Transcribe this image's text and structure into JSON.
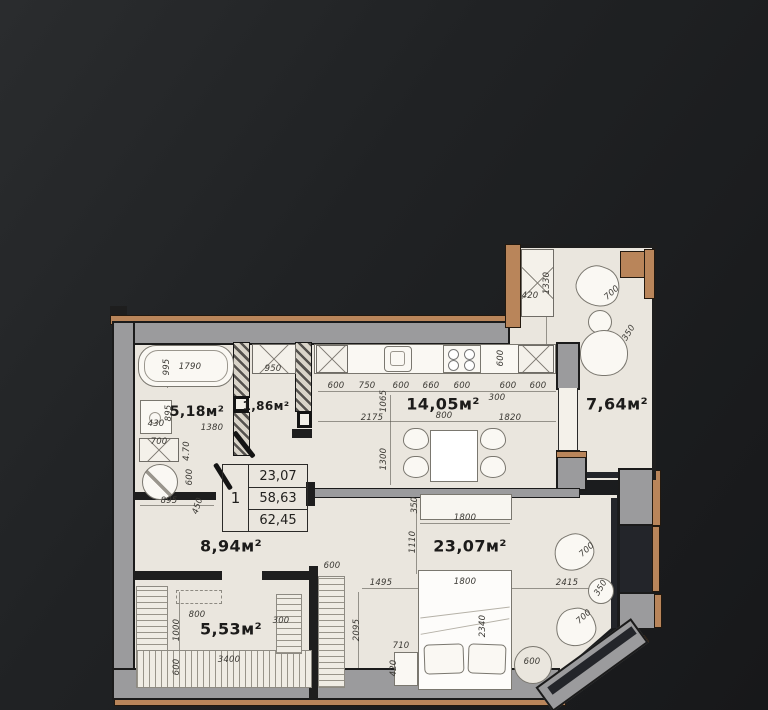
{
  "plan": {
    "title": "apartment-floor-plan",
    "legend": {
      "number": "1",
      "values": [
        "23,07",
        "58,63",
        "62,45"
      ]
    },
    "rooms": [
      {
        "name": "bathroom",
        "area": "5,18м²"
      },
      {
        "name": "closet",
        "area": "1,86м²"
      },
      {
        "name": "kitchen-living-room",
        "area": "14,05м²"
      },
      {
        "name": "balcony",
        "area": "7,64м²"
      },
      {
        "name": "hallway",
        "area": "8,94м²"
      },
      {
        "name": "bedroom",
        "area": "23,07м²"
      },
      {
        "name": "wardrobe-room",
        "area": "5,53м²"
      }
    ],
    "room_labels": [
      {
        "t": "5,18м²",
        "x": 197,
        "y": 412,
        "fs": 14
      },
      {
        "t": "1,86м²",
        "x": 266,
        "y": 406,
        "fs": 12
      },
      {
        "t": "14,05м²",
        "x": 443,
        "y": 404,
        "fs": 16
      },
      {
        "t": "7,64м²",
        "x": 617,
        "y": 404,
        "fs": 16
      },
      {
        "t": "8,94м²",
        "x": 231,
        "y": 546,
        "fs": 16
      },
      {
        "t": "23,07м²",
        "x": 470,
        "y": 546,
        "fs": 16
      },
      {
        "t": "5,53м²",
        "x": 231,
        "y": 629,
        "fs": 16
      }
    ],
    "dimensions": [
      {
        "t": "995",
        "x": 167,
        "y": 367,
        "r": -90
      },
      {
        "t": "1790",
        "x": 190,
        "y": 367
      },
      {
        "t": "950",
        "x": 273,
        "y": 369
      },
      {
        "t": "600",
        "x": 336,
        "y": 386
      },
      {
        "t": "750",
        "x": 367,
        "y": 386
      },
      {
        "t": "600",
        "x": 401,
        "y": 386
      },
      {
        "t": "660",
        "x": 431,
        "y": 386
      },
      {
        "t": "600",
        "x": 462,
        "y": 386
      },
      {
        "t": "600",
        "x": 508,
        "y": 386
      },
      {
        "t": "600",
        "x": 538,
        "y": 386
      },
      {
        "t": "600",
        "x": 501,
        "y": 358,
        "r": -90
      },
      {
        "t": "1065",
        "x": 384,
        "y": 401,
        "r": -90
      },
      {
        "t": "300",
        "x": 497,
        "y": 398
      },
      {
        "t": "2175",
        "x": 372,
        "y": 418
      },
      {
        "t": "800",
        "x": 444,
        "y": 416
      },
      {
        "t": "1820",
        "x": 510,
        "y": 418
      },
      {
        "t": "1300",
        "x": 384,
        "y": 459,
        "r": -90
      },
      {
        "t": "430",
        "x": 156,
        "y": 424
      },
      {
        "t": "895",
        "x": 169,
        "y": 413,
        "r": -90
      },
      {
        "t": "1380",
        "x": 212,
        "y": 428
      },
      {
        "t": "700",
        "x": 159,
        "y": 442
      },
      {
        "t": "4.70",
        "x": 187,
        "y": 451,
        "r": -90
      },
      {
        "t": "600",
        "x": 190,
        "y": 477,
        "r": -90
      },
      {
        "t": "895",
        "x": 169,
        "y": 501
      },
      {
        "t": "450",
        "x": 198,
        "y": 506,
        "r": -72
      },
      {
        "t": "420",
        "x": 530,
        "y": 296
      },
      {
        "t": "1330",
        "x": 547,
        "y": 283,
        "r": -90
      },
      {
        "t": "700",
        "x": 612,
        "y": 293,
        "r": -42
      },
      {
        "t": "350",
        "x": 629,
        "y": 333,
        "r": -58
      },
      {
        "t": "350",
        "x": 415,
        "y": 505,
        "r": -90
      },
      {
        "t": "1800",
        "x": 465,
        "y": 518
      },
      {
        "t": "1110",
        "x": 413,
        "y": 542,
        "r": -90
      },
      {
        "t": "1800",
        "x": 465,
        "y": 582
      },
      {
        "t": "2415",
        "x": 567,
        "y": 583
      },
      {
        "t": "2340",
        "x": 483,
        "y": 626,
        "r": -90
      },
      {
        "t": "700",
        "x": 587,
        "y": 550,
        "r": -42
      },
      {
        "t": "350",
        "x": 601,
        "y": 588,
        "r": -58
      },
      {
        "t": "700",
        "x": 584,
        "y": 617,
        "r": -42
      },
      {
        "t": "710",
        "x": 401,
        "y": 646
      },
      {
        "t": "420",
        "x": 394,
        "y": 668,
        "r": -90
      },
      {
        "t": "600",
        "x": 532,
        "y": 662
      },
      {
        "t": "600",
        "x": 332,
        "y": 566
      },
      {
        "t": "1495",
        "x": 381,
        "y": 583
      },
      {
        "t": "2095",
        "x": 357,
        "y": 630,
        "r": -90
      },
      {
        "t": "800",
        "x": 197,
        "y": 615
      },
      {
        "t": "1000",
        "x": 177,
        "y": 630,
        "r": -90
      },
      {
        "t": "300",
        "x": 281,
        "y": 621
      },
      {
        "t": "3400",
        "x": 229,
        "y": 660
      },
      {
        "t": "600",
        "x": 177,
        "y": 667,
        "r": -90
      }
    ],
    "colors": {
      "background": "#1f2123",
      "floor": "#eae6de",
      "wall_gray": "#9b9b9d",
      "wood_trim": "#b9855a",
      "outline": "#1b1b1b",
      "text": "#1c1b1a"
    }
  }
}
